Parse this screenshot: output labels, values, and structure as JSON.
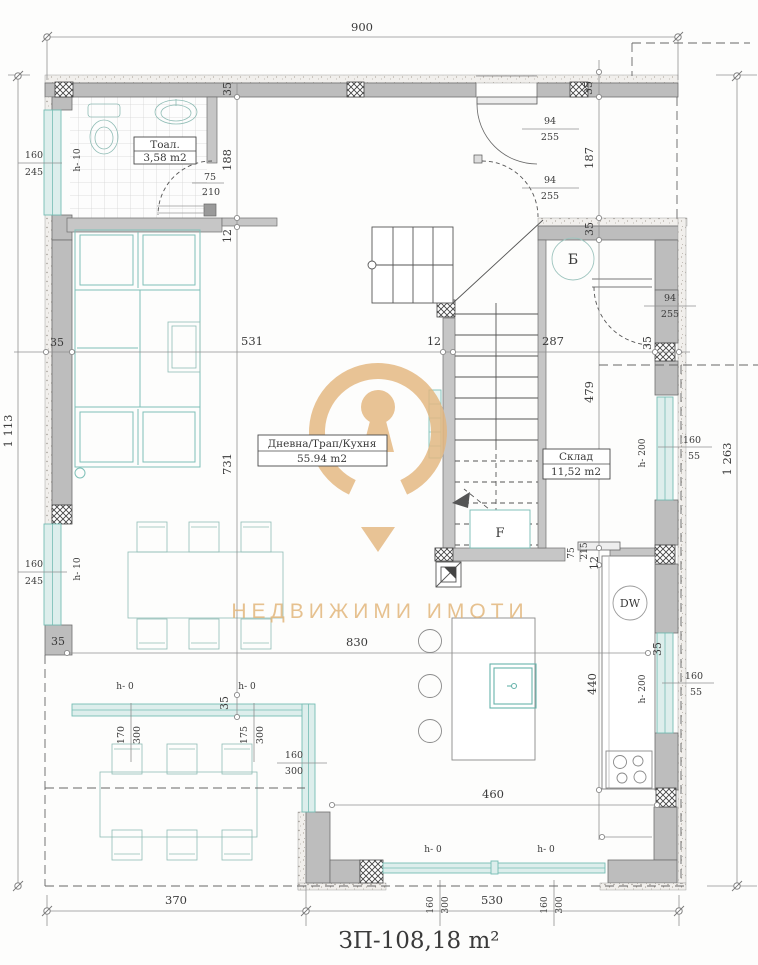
{
  "plan": {
    "title": "ЗП-108,18 m²",
    "watermark": "НЕДВИЖИМИ ИМОТИ",
    "rooms": {
      "toilet": {
        "name": "Тоал.",
        "area": "3,58 m2"
      },
      "living": {
        "name": "Дневна/Трап/Кухня",
        "area": "55.94 m2"
      },
      "storage": {
        "name": "Склад",
        "area": "11,52 m2"
      }
    },
    "marks": {
      "boiler": "Б",
      "dishwasher": "DW",
      "fridge": "F"
    },
    "dims": {
      "d900": "900",
      "d1113": "1 113",
      "d1263": "1 263",
      "d370": "370",
      "d530": "530",
      "d830": "830",
      "d460": "460",
      "d531": "531",
      "d287": "287",
      "d188": "188",
      "d187": "187",
      "d731": "731",
      "d479": "479",
      "d440": "440",
      "d12": "12",
      "d35": "35",
      "d75": "75",
      "d94": "94",
      "d255": "255",
      "d210": "210",
      "d215": "215",
      "d160": "160",
      "d245": "245",
      "d300": "300",
      "d170": "170",
      "d175": "175",
      "d55": "55",
      "h0": "h- 0",
      "h10": "h- 10",
      "h200": "h- 200"
    }
  }
}
